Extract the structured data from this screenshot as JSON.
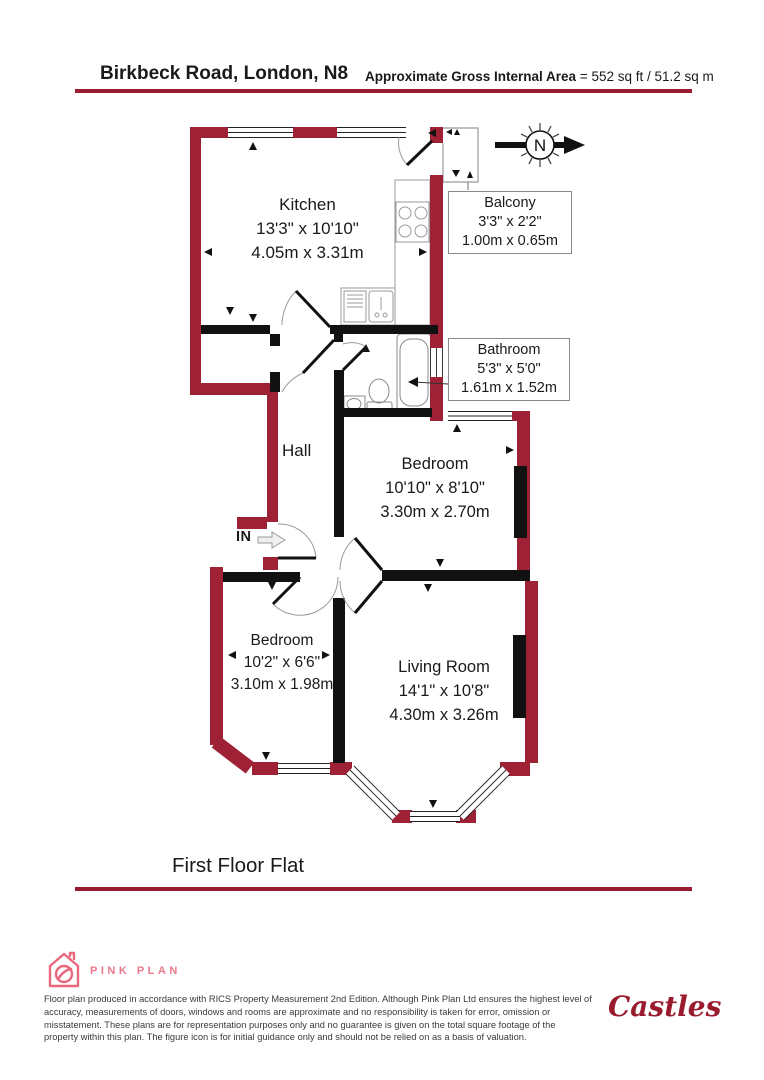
{
  "header": {
    "title": "Birkbeck Road, London, N8",
    "area_label": "Approximate Gross Internal Area",
    "area_value": " = 552 sq ft / 51.2 sq m"
  },
  "compass": {
    "label": "N"
  },
  "rooms": {
    "kitchen": {
      "name": "Kitchen",
      "imperial": "13'3\" x 10'10\"",
      "metric": "4.05m x 3.31m"
    },
    "balcony": {
      "name": "Balcony",
      "imperial": "3'3\" x 2'2\"",
      "metric": "1.00m x 0.65m"
    },
    "bathroom": {
      "name": "Bathroom",
      "imperial": "5'3\" x 5'0\"",
      "metric": "1.61m x 1.52m"
    },
    "hall": {
      "name": "Hall"
    },
    "bedroom1": {
      "name": "Bedroom",
      "imperial": "10'10\" x 8'10\"",
      "metric": "3.30m x 2.70m"
    },
    "bedroom2": {
      "name": "Bedroom",
      "imperial": "10'2\" x 6'6\"",
      "metric": "3.10m x 1.98m"
    },
    "living_room": {
      "name": "Living Room",
      "imperial": "14'1\" x 10'8\"",
      "metric": "4.30m x 3.26m"
    }
  },
  "entrance": {
    "label": "IN"
  },
  "floor_label": "First Floor Flat",
  "footer": {
    "brand": "PINK PLAN",
    "disclaimer": "Floor plan produced in accordance with RICS Property Measurement 2nd Edition. Although Pink Plan Ltd ensures the highest level of accuracy, measurements of doors, windows and rooms are approximate and no responsibility is taken for error, omission or misstatement. These plans are for representation purposes only and no guarantee is given on the total square footage of the property within this plan. The figure icon is for initial guidance only and should not be relied on as a basis of valuation.",
    "agent_logo": "Castles"
  },
  "colors": {
    "wall": "#9e2136",
    "accent_line": "#9a1c30",
    "pink": "#e8697e",
    "castles_red": "#9a1b2e"
  }
}
